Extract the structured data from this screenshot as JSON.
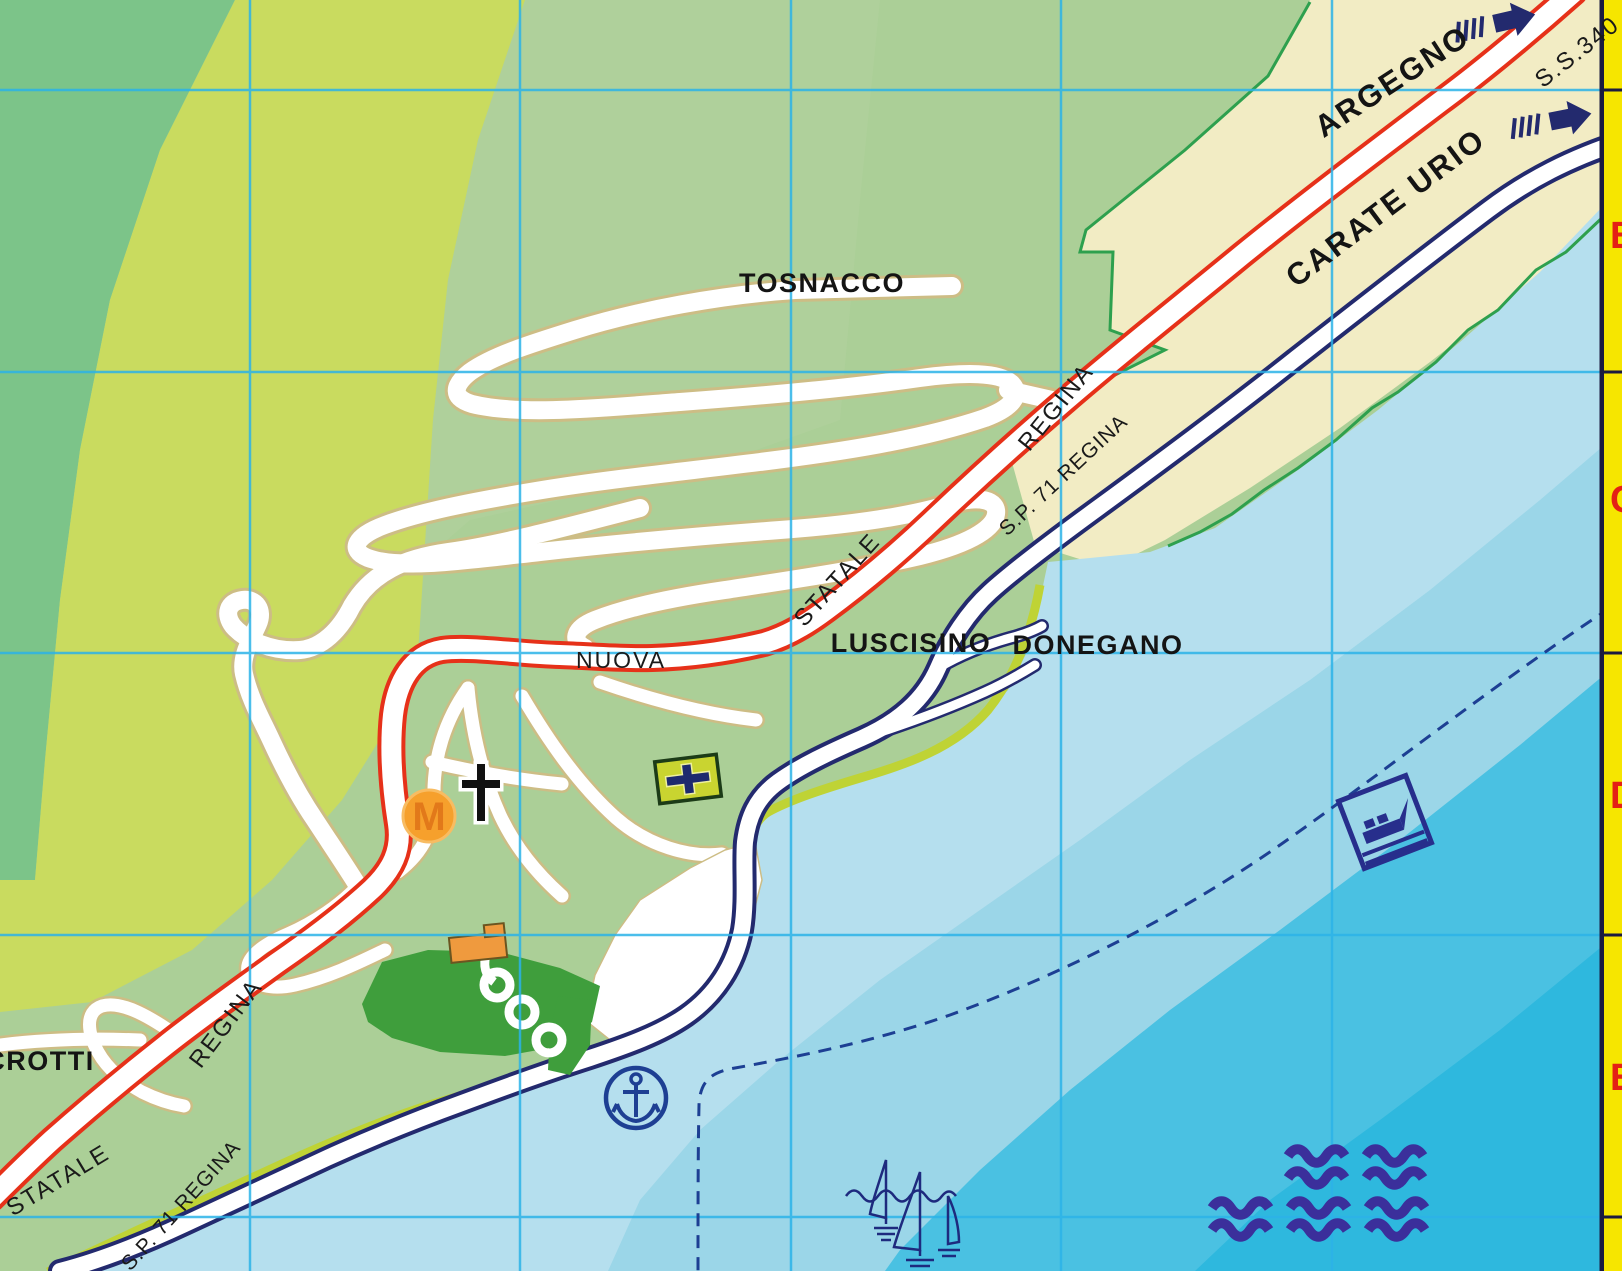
{
  "labels": {
    "tosnacco": "TOSNACCO",
    "argegno": "ARGEGNO",
    "ss340": "S.S.340",
    "carate_urio": "CARATE URIO",
    "regina_upper": "REGINA",
    "sp71_upper": "S.P. 71 REGINA",
    "statale_upper": "STATALE",
    "luscisino": "LUSCISINO",
    "donegano": "DONEGANO",
    "nuova": "NUOVA",
    "crotti": "CROTTI",
    "regina_lower": "REGINA",
    "statale_lower": "STATALE",
    "sp71_lower": "S.P. 71 REGINA",
    "m_marker": "M"
  },
  "edge_rows": [
    "B",
    "C",
    "D",
    "E"
  ],
  "icons": [
    "church-icon",
    "monument-m-icon",
    "first-aid-icon",
    "anchor-icon",
    "ferry-icon",
    "regatta-icon",
    "waves-icon",
    "direction-arrow-icon"
  ],
  "colors": {
    "state_road_red": "#e63119",
    "provincial_road_navy": "#232a6e",
    "grid_cyan": "#2cb3e8",
    "terrain_green": "#abcf97",
    "terrain_dark_green": "#7cc489",
    "terrain_yellow_green": "#c9db5f",
    "builtup_beige": "#f2ecc4",
    "field_green": "#3f9e3c",
    "lake_shallow": "#b5dfee",
    "lake_mid": "#9bd6e8",
    "lake_deep": "#4ac1e2",
    "lake_deepest": "#2eb8de",
    "shore_olive": "#bfd335",
    "edge_strip_yellow": "#f6e600",
    "edge_letter_red": "#e42015",
    "marker_orange": "#f6a02c"
  }
}
